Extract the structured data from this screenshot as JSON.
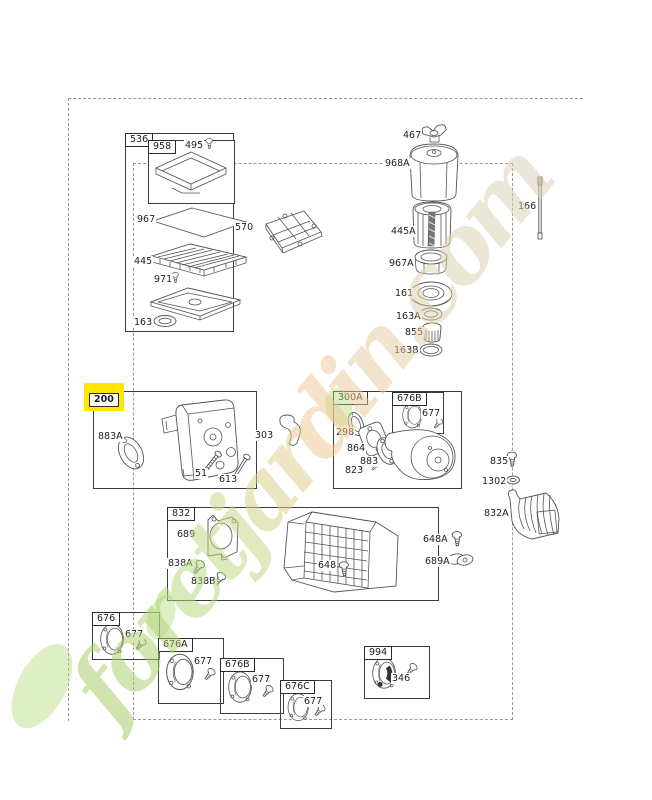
{
  "watermark": {
    "text": "foretjardin.com"
  },
  "colors": {
    "highlight_yellow": "#ffe600",
    "frame_dash_gray": "#9a9a9a",
    "line_ink": "#555555",
    "wm_green": "#9cc75a",
    "wm_peach": "#f2c793",
    "wm_khaki": "#d9d0b5"
  },
  "selected_ref": "200",
  "labels": {
    "b536": "536",
    "b958": "958",
    "p495": "495",
    "p967": "967",
    "p445": "445",
    "p971": "971",
    "p163": "163",
    "p570": "570",
    "p467": "467",
    "p968a": "968A",
    "p445a": "445A",
    "p967a": "967A",
    "p161": "161",
    "p163a": "163A",
    "p855": "855",
    "p163b": "163B",
    "p166": "166",
    "b200": "200",
    "p883a": "883A",
    "p51": "51",
    "p613": "613",
    "p303": "303",
    "b300a": "300A",
    "b676b_inner": "676B",
    "p677_inner": "677",
    "p298": "298",
    "p864": "864",
    "p883": "883",
    "p823": "823",
    "p835": "835",
    "p1302": "1302",
    "p832a": "832A",
    "b832": "832",
    "p689": "689",
    "p838a": "838A",
    "p838b": "838B",
    "p648": "648",
    "p648a": "648A",
    "p689a": "689A",
    "b676": "676",
    "p677_1": "677",
    "b676a": "676A",
    "p677_2": "677",
    "b676b2": "676B",
    "p677_3": "677",
    "b676c": "676C",
    "p677_4": "677",
    "b994": "994",
    "p346": "346"
  }
}
